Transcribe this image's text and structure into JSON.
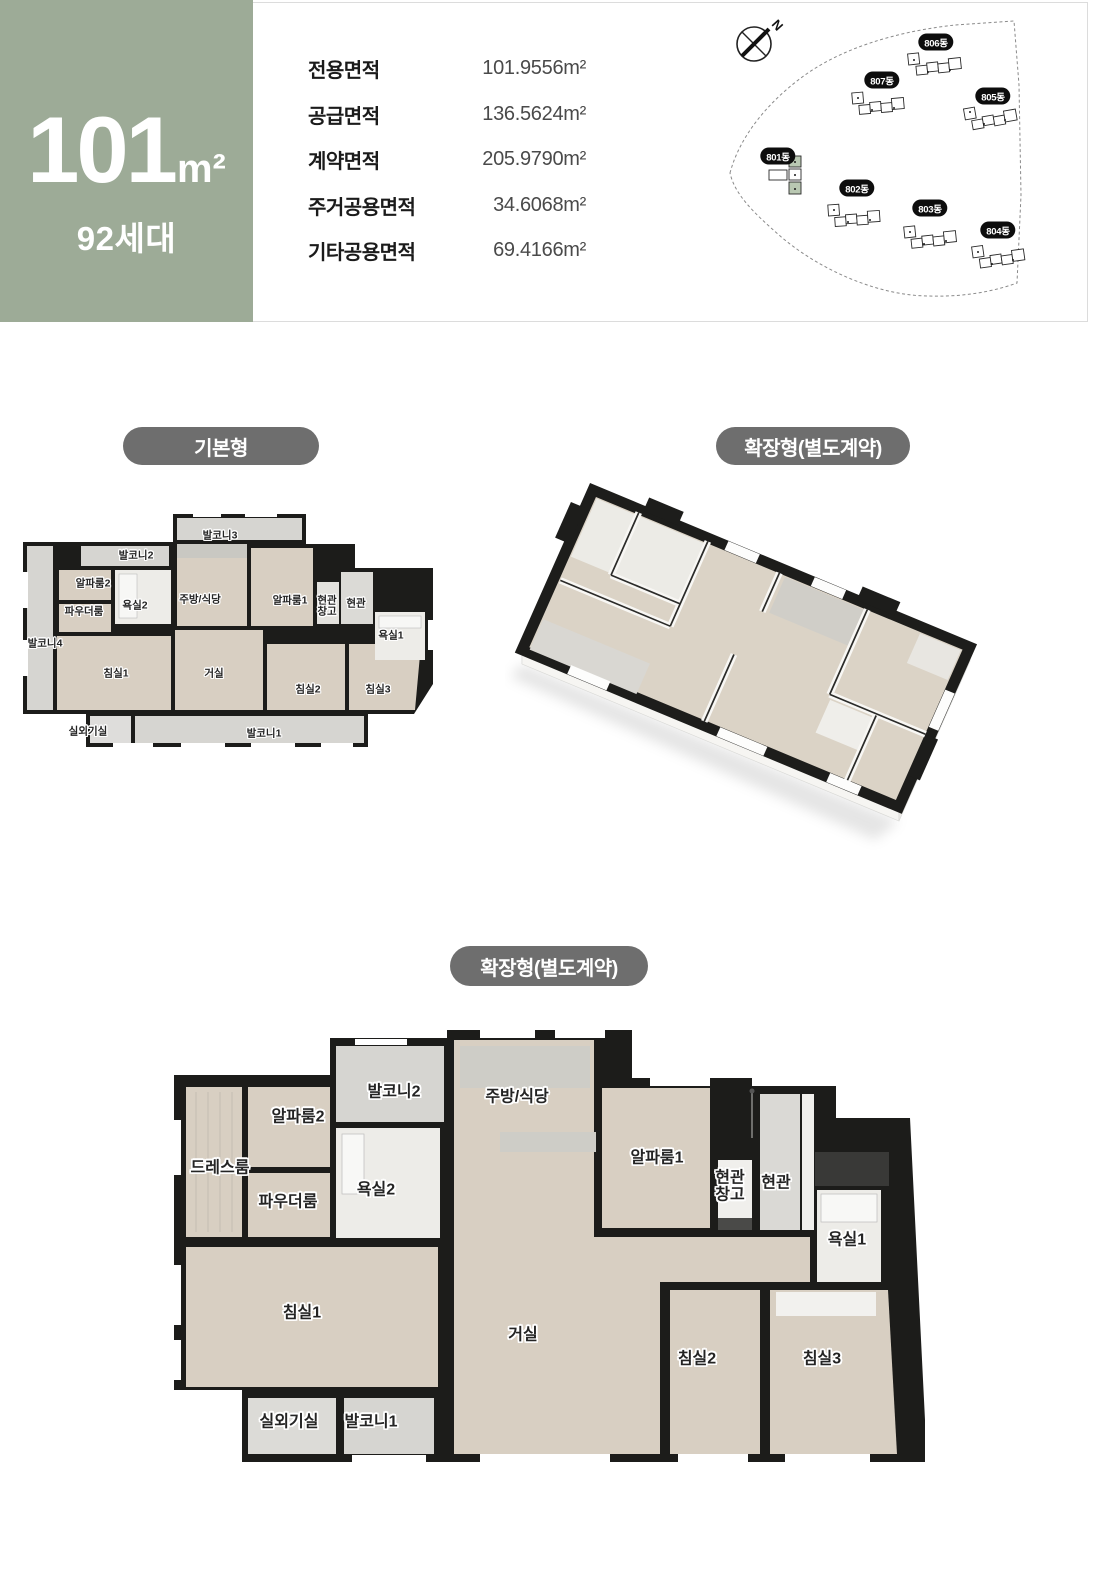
{
  "badge": {
    "area_value": "101",
    "area_unit": "m²",
    "households": "92세대"
  },
  "header": {
    "area_table": {
      "rows": [
        {
          "label": "전용면적",
          "value": "101.9556m²"
        },
        {
          "label": "공급면적",
          "value": "136.5624m²"
        },
        {
          "label": "계약면적",
          "value": "205.9790m²"
        },
        {
          "label": "주거공용면적",
          "value": "34.6068m²"
        },
        {
          "label": "기타공용면적",
          "value": "69.4166m²"
        }
      ]
    },
    "site_map": {
      "compass_label": "N",
      "buildings": [
        {
          "label": "806동",
          "x": 236,
          "y": 34,
          "highlighted": false
        },
        {
          "label": "807동",
          "x": 182,
          "y": 72,
          "highlighted": false
        },
        {
          "label": "805동",
          "x": 293,
          "y": 88,
          "highlighted": false
        },
        {
          "label": "801동",
          "x": 78,
          "y": 148,
          "highlighted": true
        },
        {
          "label": "802동",
          "x": 157,
          "y": 180,
          "highlighted": false
        },
        {
          "label": "803동",
          "x": 230,
          "y": 200,
          "highlighted": false
        },
        {
          "label": "804동",
          "x": 298,
          "y": 222,
          "highlighted": false
        }
      ]
    }
  },
  "sections": {
    "basic": {
      "tag": "기본형",
      "rooms": [
        {
          "label": "발코니3",
          "x": 197,
          "y": 24
        },
        {
          "label": "발코니2",
          "x": 113,
          "y": 44
        },
        {
          "label": "알파룸2",
          "x": 70,
          "y": 72
        },
        {
          "label": "욕실2",
          "x": 112,
          "y": 94
        },
        {
          "label": "주방/식당",
          "x": 177,
          "y": 88
        },
        {
          "label": "알파룸1",
          "x": 267,
          "y": 89
        },
        {
          "label": "현관\n창고",
          "x": 304,
          "y": 95
        },
        {
          "label": "현관",
          "x": 333,
          "y": 92
        },
        {
          "label": "파우더룸",
          "x": 61,
          "y": 100
        },
        {
          "label": "발코니4",
          "x": 22,
          "y": 132
        },
        {
          "label": "욕실1",
          "x": 368,
          "y": 124
        },
        {
          "label": "침실1",
          "x": 93,
          "y": 162
        },
        {
          "label": "거실",
          "x": 191,
          "y": 162
        },
        {
          "label": "침실2",
          "x": 285,
          "y": 178
        },
        {
          "label": "침실3",
          "x": 355,
          "y": 178
        },
        {
          "label": "실외기실",
          "x": 65,
          "y": 220
        },
        {
          "label": "발코니1",
          "x": 241,
          "y": 222
        }
      ]
    },
    "extended_3d": {
      "tag": "확장형(별도계약)"
    },
    "extended": {
      "tag": "확장형(별도계약)",
      "rooms": [
        {
          "label": "발코니2",
          "x": 224,
          "y": 62
        },
        {
          "label": "주방/식당",
          "x": 347,
          "y": 67
        },
        {
          "label": "알파룸2",
          "x": 128,
          "y": 87
        },
        {
          "label": "드레스룸",
          "x": 50,
          "y": 138
        },
        {
          "label": "욕실2",
          "x": 206,
          "y": 160
        },
        {
          "label": "파우더룸",
          "x": 118,
          "y": 172
        },
        {
          "label": "알파룸1",
          "x": 487,
          "y": 128
        },
        {
          "label": "현관\n창고",
          "x": 560,
          "y": 157
        },
        {
          "label": "현관",
          "x": 606,
          "y": 153
        },
        {
          "label": "욕실1",
          "x": 677,
          "y": 210
        },
        {
          "label": "침실1",
          "x": 132,
          "y": 283
        },
        {
          "label": "거실",
          "x": 353,
          "y": 305
        },
        {
          "label": "침실2",
          "x": 527,
          "y": 329
        },
        {
          "label": "침실3",
          "x": 652,
          "y": 329
        },
        {
          "label": "실외기실",
          "x": 119,
          "y": 392
        },
        {
          "label": "발코니1",
          "x": 201,
          "y": 392
        }
      ]
    }
  },
  "colors": {
    "badge_green": "#9dab97",
    "pill_gray": "#6e6e6e",
    "wall": "#1c1c1a",
    "floor": "#d8cfc2",
    "balcony": "#d6d5d1",
    "highlight_building": "#b9c8b2"
  }
}
